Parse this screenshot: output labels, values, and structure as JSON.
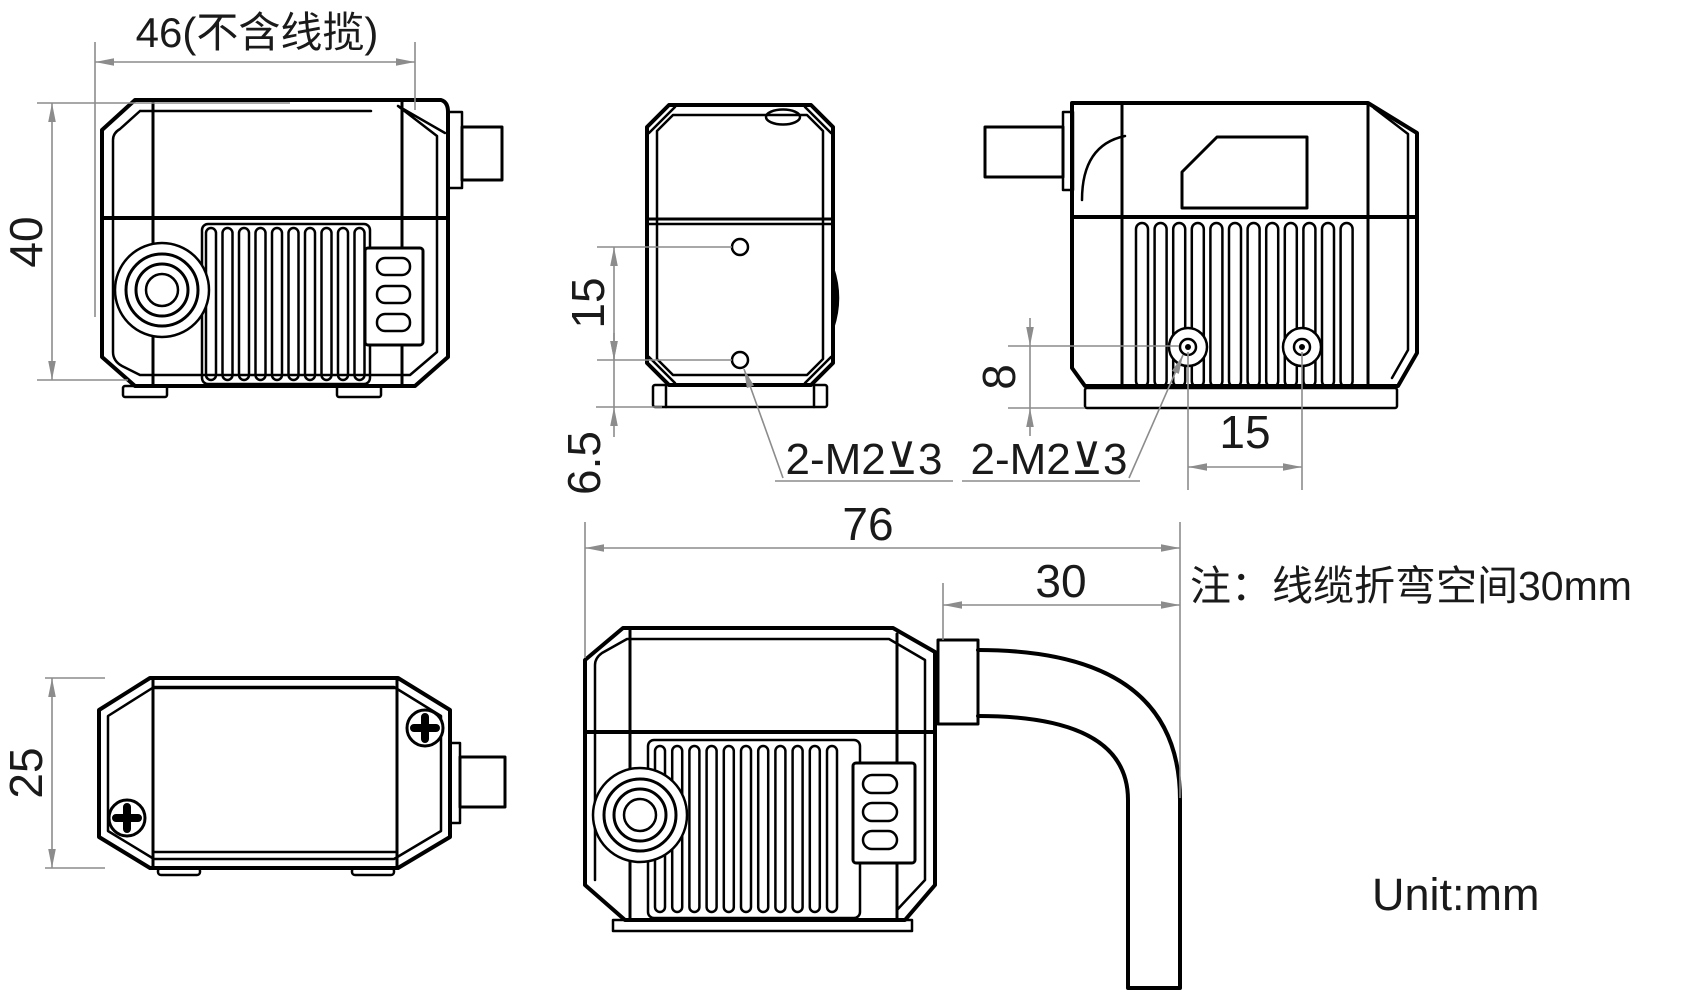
{
  "unit_label": "Unit:mm",
  "note": "注：线缆折弯空间30mm",
  "colors": {
    "line": "#000000",
    "dimension": "#8c8c8c",
    "background": "#ffffff"
  },
  "views": {
    "front": {
      "width": "46(不含线揽)",
      "height": "40"
    },
    "side": {
      "hole_spacing": "15",
      "hole_bottom_offset": "6.5",
      "thread_callout": "2-M2⊻3"
    },
    "rear": {
      "thread_callout": "2-M2⊻3",
      "hole_bottom_offset": "8",
      "hole_spacing": "15"
    },
    "top": {
      "height": "25"
    },
    "cable_side": {
      "overall_length": "76",
      "bend_space": "30"
    }
  }
}
